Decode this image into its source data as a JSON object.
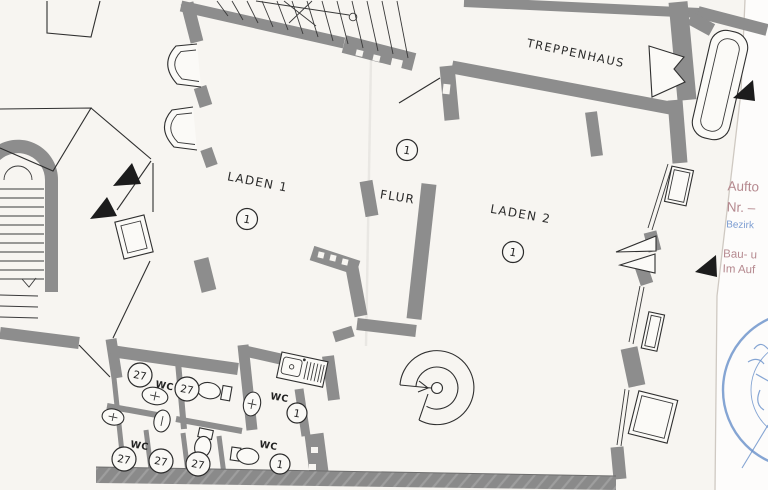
{
  "plan": {
    "rooms": {
      "treppenhaus": {
        "label": "TREPPENHAUS"
      },
      "laden1": {
        "label": "LADEN 1",
        "number": "1"
      },
      "flur": {
        "label": "FLUR",
        "number": "1"
      },
      "laden2": {
        "label": "LADEN 2",
        "number": "1"
      }
    },
    "wc": {
      "labels": [
        "WC",
        "WC",
        "WC",
        "WC"
      ],
      "room_numbers": [
        "1",
        "1"
      ],
      "unit_numbers": [
        "27",
        "27",
        "27",
        "27",
        "27"
      ]
    }
  },
  "annotations": {
    "side_notes": [
      "Aufto",
      "Nr. –",
      "Bezirk",
      "Bau- u",
      "Im Auf"
    ],
    "stamp_text": "BEZIRKSAMT ·"
  },
  "colors": {
    "wall_gray": "#8d8d8d",
    "line_ink": "#2f2f2f",
    "paper": "#f7f5f1",
    "paper_right": "#fdfcfb",
    "note_red": "#b5898f",
    "note_blue": "#7b9cd1",
    "stamp_blue": "#4d7cc0"
  }
}
